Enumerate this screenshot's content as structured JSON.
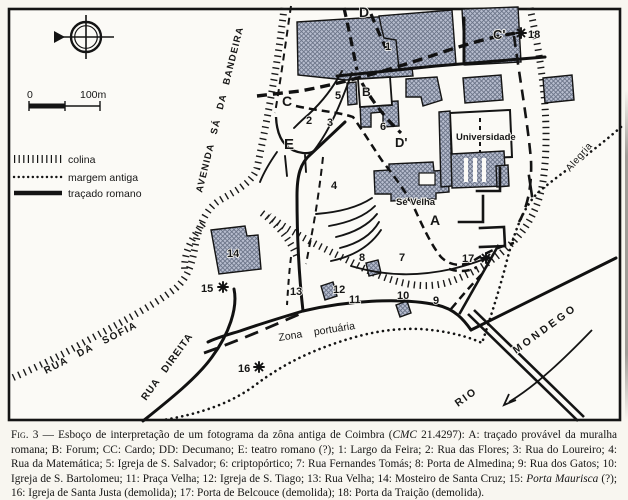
{
  "figure_caption": {
    "fig_label": "Fig. 3",
    "dash": " — ",
    "body_before_cmc": "Esboço de interpretação de um fotograma da zôna antiga de Coimbra (",
    "cmc": "CMC",
    "body_after_cmc": " 21.4297): A: traçado provável da muralha romana; B: Forum; CC: Cardo; DD: Decumano; E: teatro romano (?); 1: Largo da Feira; 2: Rua das Flores; 3: Rua do Loureiro; 4: Rua da Matemática; 5: Igreja de S. Salvador; 6: criptopórtico; 7: Rua Fernandes Tomás; 8: Porta de Almedina; 9: Rua dos Gatos; 10: Igreja de S. Bartolomeu; 11: Praça Velha; 12: Igreja de S. Tiago; 13: Rua Velha; 14: Mosteiro de Santa Cruz; 15: ",
    "porta_maurisca": "Porta Maurisca",
    "body_end": " (?); 16: Igreja de Santa Justa (demolida); 17: Porta de Belcouce (demolida); 18: Porta da Traição (demolida)."
  },
  "legend": {
    "colina": "colina",
    "margem": "margem antiga",
    "tracado": "traçado romano"
  },
  "scale_bar": {
    "zero": "0",
    "max": "100m"
  },
  "streets": {
    "avenida": "AVENIDA SÁ DA BANDEIRA",
    "sofia": "RUA DA SOFIA",
    "direita": "RUA DIREITA",
    "zona_portuaria": "Zona portuária",
    "rio": "RIO",
    "mondego": "MONDEGO",
    "alegria": "Alegria"
  },
  "places": {
    "universidade": "Universidade",
    "se_velha": "Sé Velha"
  },
  "letters": {
    "a": "A",
    "b": "B",
    "c": "C",
    "c_prime": "C'",
    "d": "D",
    "d_prime": "D'",
    "e": "E"
  },
  "numbers": {
    "n1": "1",
    "n2": "2",
    "n3": "3",
    "n4": "4",
    "n5": "5",
    "n6": "6",
    "n7": "7",
    "n8": "8",
    "n9": "9",
    "n10": "10",
    "n11": "11",
    "n12": "12",
    "n13": "13",
    "n14": "14",
    "n15": "15",
    "n16": "16",
    "n17": "17",
    "n18": "18"
  },
  "colors": {
    "ink": "#161616",
    "paper": "#f8f6f0",
    "building_fill": "#b7bdce",
    "building_hatch": "#6b7488"
  }
}
